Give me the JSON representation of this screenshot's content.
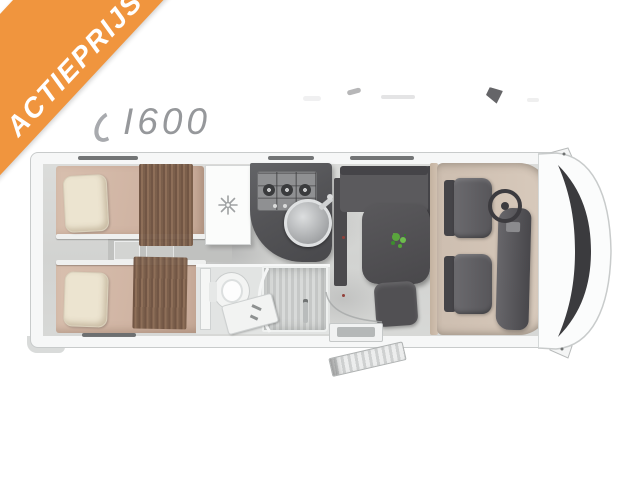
{
  "banner": {
    "label": "ACTIEPRIJS",
    "bg_color": "#F0953E",
    "text_color": "#FFFFFF"
  },
  "model": {
    "label": "I600",
    "text_color": "#96989B"
  },
  "floorplan": {
    "type": "motorhome-top-view-layout",
    "zones": [
      "rear-twin-beds",
      "fridge",
      "kitchen",
      "bathroom",
      "dinette",
      "cab"
    ],
    "features": [
      "twin-bed-top",
      "twin-bed-bottom",
      "pillows",
      "bed-throws",
      "bed-steps",
      "fridge-with-snowflake-icon",
      "three-burner-hob",
      "round-sink",
      "toilet",
      "vanity-sink",
      "shower",
      "dinette-l-sofa",
      "dinette-table",
      "plant-on-table",
      "stool",
      "driver-seat",
      "passenger-seat",
      "steering-wheel",
      "dashboard",
      "windshield",
      "side-mirror-top",
      "side-mirror-bottom",
      "entry-step",
      "open-entry-door",
      "windows"
    ]
  },
  "colors": {
    "banner_orange": "#F0953E",
    "model_text_gray": "#96989B",
    "bed_tan": "#D4B9A9",
    "pillow_cream": "#ECE4D0",
    "throw_brown": "#7A5A43",
    "counter_gray": "#57575A",
    "sofa_gray": "#5B5A5D",
    "cab_floor_tan": "#CFC0B2",
    "plant_green": "#58A43C",
    "windshield_dark": "#3B3B3E",
    "body_white": "#FBFCFC",
    "floor_gray": "#D6D7D5"
  }
}
